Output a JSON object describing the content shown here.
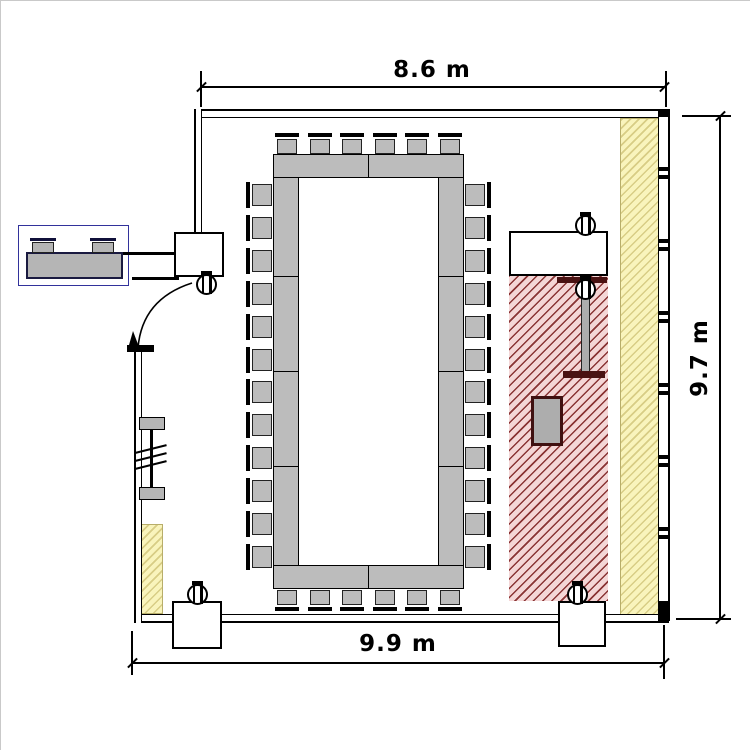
{
  "dimensions": {
    "top_width": "8.6 m",
    "right_height": "9.7 m",
    "bottom_width": "9.9 m"
  },
  "colors": {
    "wall_line": "#000000",
    "furniture_fill": "#bcbcbc",
    "zone_red_base": "#f4d6d6",
    "zone_red_hatch": "#8a3434",
    "zone_yellow_base": "#f9f4bc",
    "zone_yellow_hatch": "#d8cd85",
    "zone_blue_hatch": "#32329b",
    "equipment_dark": "#4a1212"
  },
  "seating": {
    "conference_table": {
      "top": 6,
      "bottom": 6,
      "left": 12,
      "right": 12
    },
    "reception_desk": 2
  },
  "window": {
    "mullion_pairs": 6
  },
  "symbols": {
    "ceiling_device": "circle-with-two-bars",
    "ceiling_device_count": 5,
    "door": "quarter-circle-swing",
    "radiator": "double-bar-with-break-ticks",
    "zones": [
      "blue-crosshatch-reception",
      "red-hatch-presentation",
      "yellow-hatch-window-strip"
    ]
  }
}
